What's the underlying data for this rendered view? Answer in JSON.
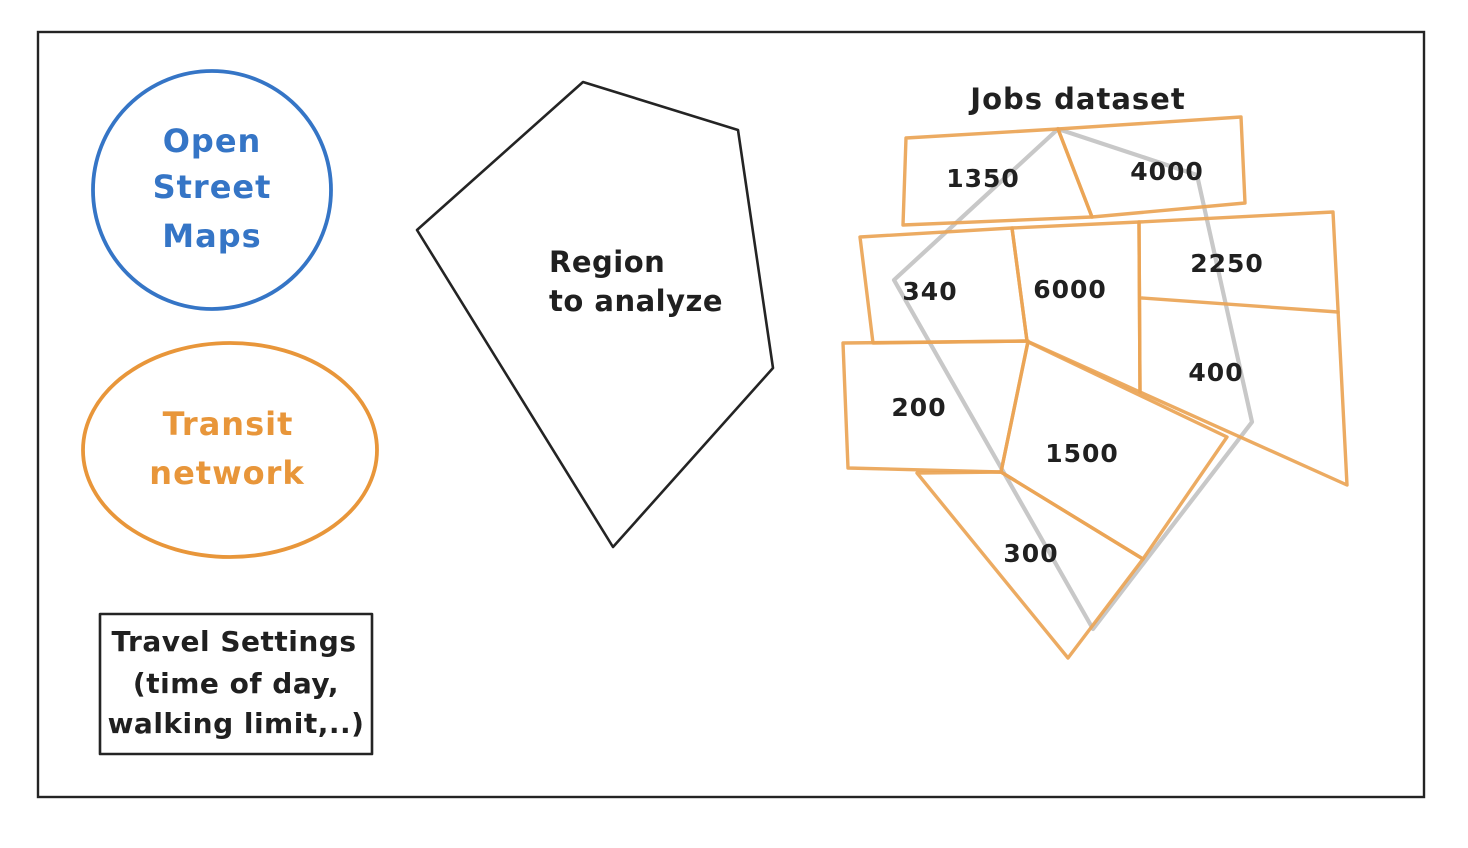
{
  "colors": {
    "frame_ink": "#242424",
    "osm_blue": "#3575c6",
    "transit_orange": "#e8963a",
    "jobs_polygon_orange": "#eaa455",
    "region_overlay_gray": "#c8c8c8",
    "text_ink": "#202020"
  },
  "osm": {
    "lines": [
      "Open",
      "Street",
      "Maps"
    ]
  },
  "transit": {
    "lines": [
      "Transit",
      "network"
    ]
  },
  "travel": {
    "lines": [
      "Travel Settings",
      "(time of day,",
      "walking limit,..)"
    ]
  },
  "region": {
    "lines": [
      "Region",
      "to analyze"
    ]
  },
  "jobs": {
    "title": "Jobs dataset",
    "zones": [
      {
        "value": "1350"
      },
      {
        "value": "4000"
      },
      {
        "value": "2250"
      },
      {
        "value": "340"
      },
      {
        "value": "6000"
      },
      {
        "value": "400"
      },
      {
        "value": "200"
      },
      {
        "value": "1500"
      },
      {
        "value": "300"
      }
    ]
  }
}
